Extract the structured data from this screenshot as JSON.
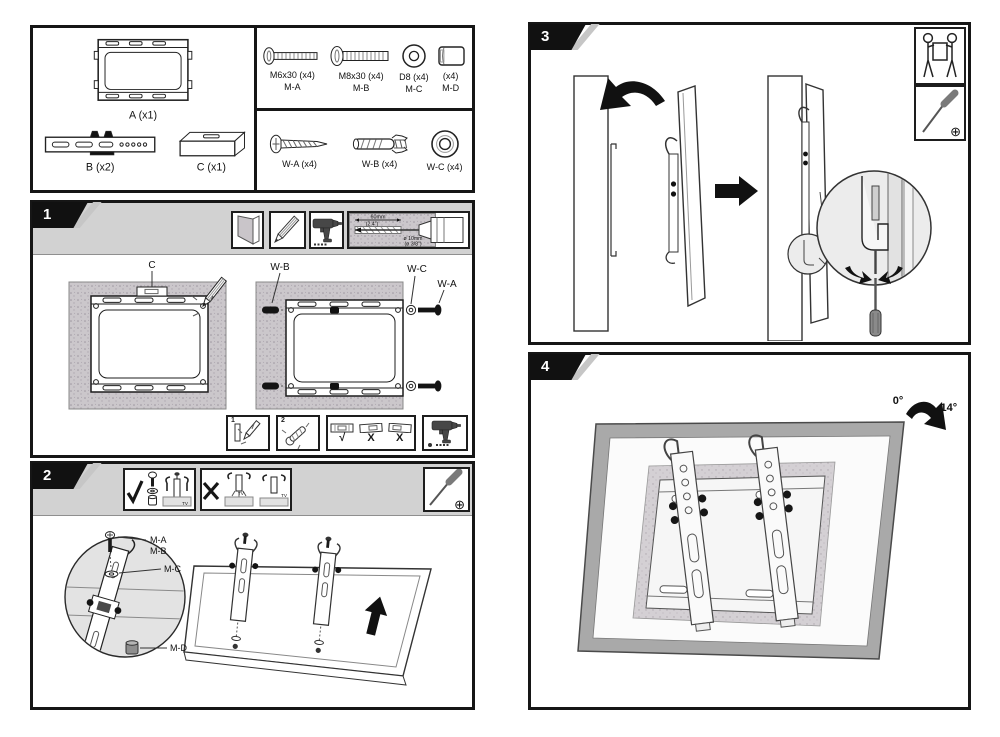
{
  "colors": {
    "ink": "#1a1a1a",
    "band_gray": "#d2d2d2",
    "wall_gray": "#cbc7cb",
    "magnifier_gray": "#e4e4e4",
    "tv_frame_gray": "#a9a9a9"
  },
  "icons": {
    "phillips": "⊕",
    "check": "✓",
    "cross": "✕"
  },
  "parts_box": {
    "a_label": "A (x1)",
    "b_label": "B (x2)",
    "c_label": "C (x1)"
  },
  "hardware": {
    "m_a_size": "M6x30 (x4)",
    "m_a_code": "M-A",
    "m_b_size": "M8x30 (x4)",
    "m_b_code": "M-B",
    "m_c_size": "D8 (x4)",
    "m_c_code": "M-C",
    "m_d_size": "(x4)",
    "m_d_code": "M-D",
    "w_a_label": "W-A (x4)",
    "w_b_label": "W-B (x4)",
    "w_c_label": "W-C (x4)"
  },
  "step1": {
    "number": "1",
    "label_c": "C",
    "label_wb": "W-B",
    "label_wc": "W-C",
    "label_wa": "W-A",
    "drill_depth_mm": "60mm",
    "drill_depth_in": "(2.4\")",
    "drill_dia_mm": "ø 10mm",
    "drill_dia_in": "(ø 3/8\")",
    "substep_1": "1",
    "substep_2": "2",
    "level_marks": [
      "√",
      "X",
      "X"
    ]
  },
  "step2": {
    "number": "2",
    "label_m_a": "M-A",
    "label_m_b": "M-B",
    "label_m_c": "M-C",
    "label_m_d": "M-D",
    "tv_labels": [
      "TV",
      "TV",
      "TV"
    ]
  },
  "step3": {
    "number": "3"
  },
  "step4": {
    "number": "4",
    "angle_from": "0°",
    "angle_to": "-14°"
  }
}
